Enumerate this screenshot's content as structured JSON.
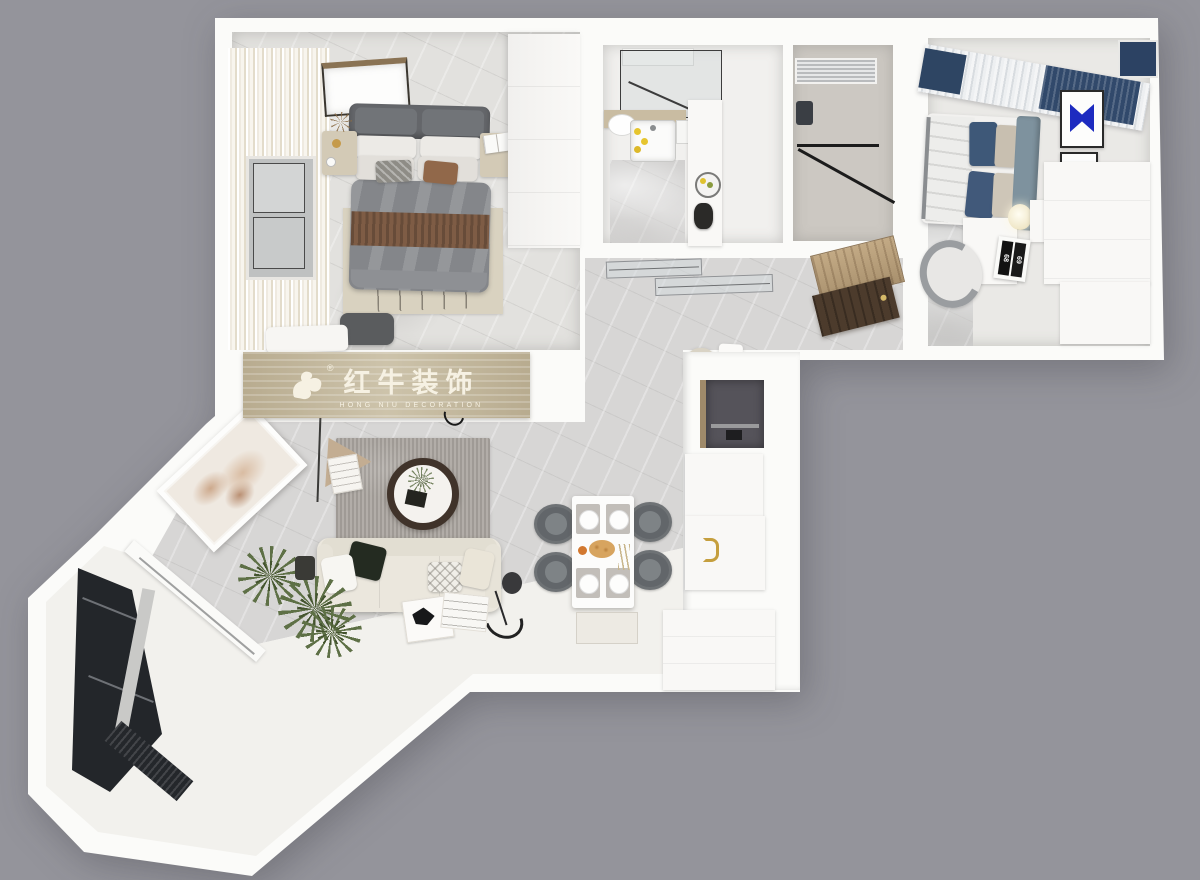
{
  "watermark": {
    "brand_cn": "红牛装饰",
    "brand_en": "HONG NIU DECORATION",
    "registered": "®"
  },
  "poster": {
    "line1": "68",
    "line2": "69"
  },
  "scene": {
    "type": "3d-floorplan-top-down-render",
    "background_color": "#94949B",
    "rooms": [
      {
        "name": "master-bedroom",
        "furniture": [
          "double-bed-gray",
          "brown-throw-blanket",
          "nightstand-left",
          "nightstand-right",
          "wardrobe",
          "sheer-window-curtains",
          "ceiling-lamp",
          "foot-bench",
          "beige-rug"
        ]
      },
      {
        "name": "bathroom",
        "furniture": [
          "glass-shower",
          "vanity-counter",
          "sink",
          "mirror",
          "yellow-ducks",
          "storage-cabinet",
          "fruit-bowl",
          "black-kettle"
        ]
      },
      {
        "name": "walk-in-closet",
        "furniture": [
          "clothes-rod-horizontal",
          "clothes-rod-diagonal",
          "roller-blind",
          "hanging-garment"
        ]
      },
      {
        "name": "second-bedroom",
        "furniture": [
          "bed-blue-headboard",
          "navy-pillows",
          "blue-wall-art-x2",
          "desk",
          "desk-lamp",
          "desk-chair",
          "number-poster",
          "white-cabinet",
          "striped-curtain",
          "navy-window"
        ]
      },
      {
        "name": "hallway",
        "furniture": [
          "sliding-glass-doors",
          "open-wood-entry-door",
          "entry-bench",
          "white-cloth"
        ]
      },
      {
        "name": "living-dining",
        "furniture": [
          "cream-sofa",
          "throw-pillows",
          "gray-area-rug",
          "round-coffee-table",
          "tv-niche",
          "media-cabinets",
          "sideboard",
          "floor-lamp",
          "floor-posters",
          "palm-plants",
          "diagonal-wall-art",
          "dining-table",
          "dining-chairs-x4",
          "placemats-x4",
          "floor-mat"
        ]
      },
      {
        "name": "balcony",
        "furniture": [
          "dark-glazing-panels",
          "ac-unit"
        ]
      }
    ],
    "colors": {
      "background": "#94949B",
      "walls": "#FBFBF9",
      "floor_marble": "#D7D6D5",
      "floor_white": "#F2F1ED",
      "logo_wood": "#C6BB9F",
      "accent_blue": "#1D2BC0",
      "navy": "#2E4563",
      "sofa_cream": "#EBE7DD",
      "bed_gray": "#84868A",
      "throw_brown": "#7E5C45",
      "glazing_dark": "#23262A"
    }
  }
}
